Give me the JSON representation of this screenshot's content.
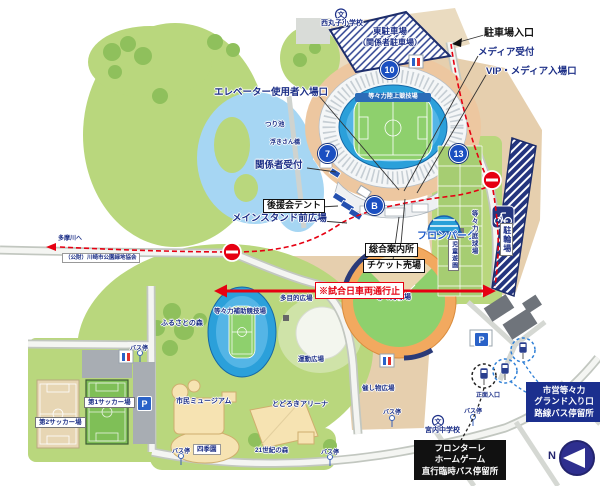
{
  "region_labels": {
    "athletics_stadium": "等々力陸上競技場",
    "baseball_stadium": "等々力球場",
    "aux_track": "等々力補助競技場",
    "tennis_courts": "等々力庭球場",
    "bicycle_parking": "駐輪場",
    "east_parking_line1": "東駐車場",
    "east_parking_line2": "（関係者駐車場）",
    "soccer1": "第1サッカー場",
    "soccer2": "第2サッカー場",
    "museum": "市民ミュージアム",
    "arena": "とどろきアリーナ",
    "furusato_forest": "ふるさとの森",
    "multipurpose_plaza": "多目的広場",
    "sports_plaza": "運動広場",
    "event_plaza": "催し物広場",
    "shiki_garden": "四季園",
    "forest_21": "21世紀の森",
    "children_garden": "児童遊園",
    "fishing_pond": "つり池",
    "bridge": "浮きさん橋",
    "elementary_school": "西丸子小学校",
    "junior_high_school": "宮内中学校",
    "main_entrance": "正面入口",
    "to_tama_river": "多摩川へ",
    "park_association": "（公財）川崎市公園緑地協会",
    "bus_stop": "バス停"
  },
  "callouts": {
    "parking_entrance": "駐車場入口",
    "media_reception": "メディア受付",
    "vip_media_gate": "VIP・メディア入場口",
    "elevator_gate": "エレベーター使用者入場口",
    "staff_reception": "関係者受付",
    "supporters_tent": "後援会テント",
    "main_stand_plaza": "メインスタンド前広場",
    "info_center": "総合案内所",
    "ticket_office": "チケット売場",
    "fron_park": "フロンパーク",
    "match_day_closed": "※試合日車両通行止"
  },
  "gates": {
    "g10": "10",
    "g7": "7",
    "g13": "13",
    "gB": "B"
  },
  "bus_info": {
    "frontale_box": {
      "line1": "フロンターレ",
      "line2": "ホームゲーム",
      "line3": "直行臨時バス停留所"
    },
    "city_box": {
      "line1": "市営等々力",
      "line2": "グランド入り口",
      "line3": "路線バス停留所"
    }
  },
  "icons": {
    "parking_p": "P",
    "school_mark": "文",
    "compass_north": "N"
  },
  "colors": {
    "navy": "#1c2f87",
    "route_red": "#e60012",
    "gate_blue": "#1b4fc1",
    "park_green": "#b9d77d",
    "water_blue": "#a6d6f3",
    "tan": "#e6cfae"
  }
}
